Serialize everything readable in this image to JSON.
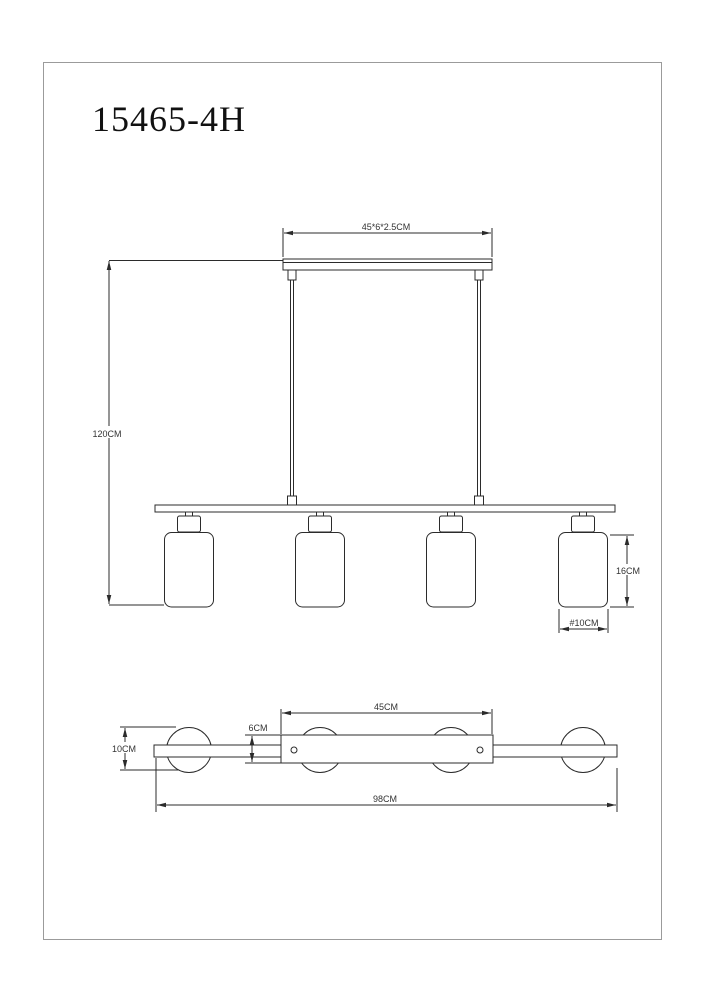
{
  "page": {
    "title": "15465-4H"
  },
  "colors": {
    "line": "#2b2b2b",
    "text": "#333333",
    "background": "#ffffff",
    "border": "#9b9b9b"
  },
  "front_view": {
    "dimensions": {
      "canopy_size": "45*6*2.5CM",
      "drop_height": "120CM",
      "shade_height": "16CM",
      "shade_diameter": "#10CM"
    }
  },
  "top_view": {
    "dimensions": {
      "canopy_length": "45CM",
      "canopy_width": "6CM",
      "shade_diameter": "10CM",
      "overall_length": "98CM"
    }
  }
}
